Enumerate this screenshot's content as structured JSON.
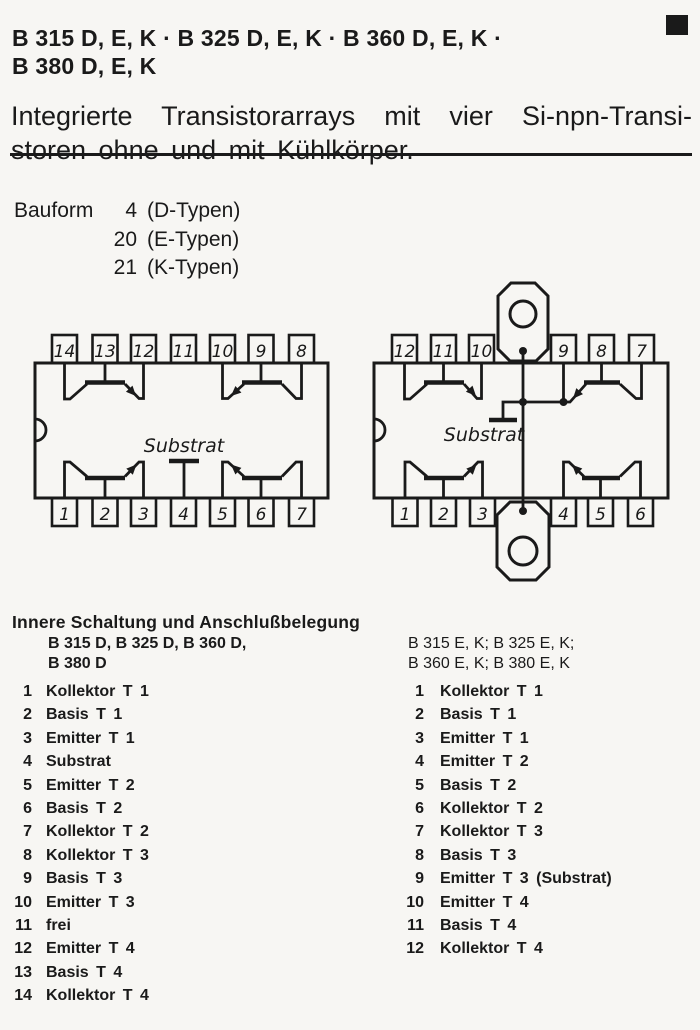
{
  "header": {
    "title_line1": "B 315 D, E, K · B 325 D, E, K · B 360 D, E, K ·",
    "title_line2": "B 380 D, E, K",
    "subtitle_line1": "Integrierte Transistorarrays mit vier Si-npn-Transi-",
    "subtitle_line2": "storen ohne und mit Kühlkörper."
  },
  "bauform": {
    "label": "Bauform",
    "rows": [
      {
        "n": "4",
        "t": "(D-Typen)"
      },
      {
        "n": "20",
        "t": "(E-Typen)"
      },
      {
        "n": "21",
        "t": "(K-Typen)"
      }
    ]
  },
  "diagrams": {
    "dip14": {
      "top_pins": [
        "14",
        "13",
        "12",
        "11",
        "10",
        "9",
        "8"
      ],
      "bottom_pins": [
        "1",
        "2",
        "3",
        "4",
        "5",
        "6",
        "7"
      ],
      "substrate_label": "Substrat"
    },
    "dip12": {
      "top_pins": [
        "12",
        "11",
        "10",
        "9",
        "8",
        "7"
      ],
      "bottom_pins": [
        "1",
        "2",
        "3",
        "4",
        "5",
        "6"
      ],
      "substrate_label": "Substrat"
    }
  },
  "pinout": {
    "heading": "Innere Schaltung und Anschlußbelegung",
    "left": {
      "header_line1": "B 315 D, B 325 D, B 360 D,",
      "header_line2": "B 380 D",
      "rows": [
        {
          "n": "1",
          "t": "Kollektor T 1"
        },
        {
          "n": "2",
          "t": "Basis T 1"
        },
        {
          "n": "3",
          "t": "Emitter T 1"
        },
        {
          "n": "4",
          "t": "Substrat"
        },
        {
          "n": "5",
          "t": "Emitter T 2"
        },
        {
          "n": "6",
          "t": "Basis T 2"
        },
        {
          "n": "7",
          "t": "Kollektor T 2"
        },
        {
          "n": "8",
          "t": "Kollektor T 3"
        },
        {
          "n": "9",
          "t": "Basis T 3"
        },
        {
          "n": "10",
          "t": "Emitter T 3"
        },
        {
          "n": "11",
          "t": "frei"
        },
        {
          "n": "12",
          "t": "Emitter T 4"
        },
        {
          "n": "13",
          "t": "Basis T 4"
        },
        {
          "n": "14",
          "t": "Kollektor T 4"
        }
      ]
    },
    "right": {
      "header_line1": "B 315 E, K; B 325 E, K;",
      "header_line2": "B 360 E, K; B 380 E, K",
      "rows": [
        {
          "n": "1",
          "t": "Kollektor T 1"
        },
        {
          "n": "2",
          "t": "Basis T 1"
        },
        {
          "n": "3",
          "t": "Emitter T 1"
        },
        {
          "n": "4",
          "t": "Emitter T 2"
        },
        {
          "n": "5",
          "t": "Basis T 2"
        },
        {
          "n": "6",
          "t": "Kollektor T 2"
        },
        {
          "n": "7",
          "t": "Kollektor T 3"
        },
        {
          "n": "8",
          "t": "Basis T 3"
        },
        {
          "n": "9",
          "t": "Emitter T 3 (Substrat)"
        },
        {
          "n": "10",
          "t": "Emitter T 4"
        },
        {
          "n": "11",
          "t": "Basis T 4"
        },
        {
          "n": "12",
          "t": "Kollektor T 4"
        }
      ]
    }
  },
  "colors": {
    "ink": "#1a1a1a",
    "paper": "#f7f6f3"
  }
}
